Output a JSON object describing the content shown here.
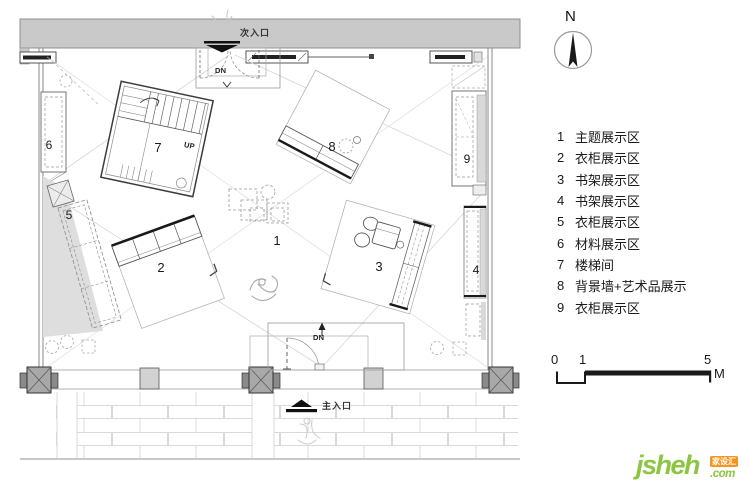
{
  "plan": {
    "entrances": {
      "secondary": "次入口",
      "main": "主入口"
    },
    "dn_label_top": "DN",
    "dn_label_bottom": "DN",
    "up_label": "UP",
    "markers": [
      {
        "num": "1"
      },
      {
        "num": "2"
      },
      {
        "num": "3"
      },
      {
        "num": "4"
      },
      {
        "num": "5"
      },
      {
        "num": "6"
      },
      {
        "num": "7"
      },
      {
        "num": "8"
      },
      {
        "num": "9"
      }
    ]
  },
  "compass": {
    "north": "N"
  },
  "legend": {
    "items": [
      {
        "num": "1",
        "label": "主题展示区"
      },
      {
        "num": "2",
        "label": "衣柜展示区"
      },
      {
        "num": "3",
        "label": "书架展示区"
      },
      {
        "num": "4",
        "label": "书架展示区"
      },
      {
        "num": "5",
        "label": "衣柜展示区"
      },
      {
        "num": "6",
        "label": "材料展示区"
      },
      {
        "num": "7",
        "label": "楼梯间"
      },
      {
        "num": "8",
        "label": "背景墙+艺术品展示"
      },
      {
        "num": "9",
        "label": "衣柜展示区"
      }
    ]
  },
  "scale_bar": {
    "tick_0": "0",
    "tick_1": "1",
    "tick_5": "5",
    "unit": "M"
  },
  "logo": {
    "brand": "jsheh",
    "tld": ".com",
    "badge": "家设汇"
  }
}
